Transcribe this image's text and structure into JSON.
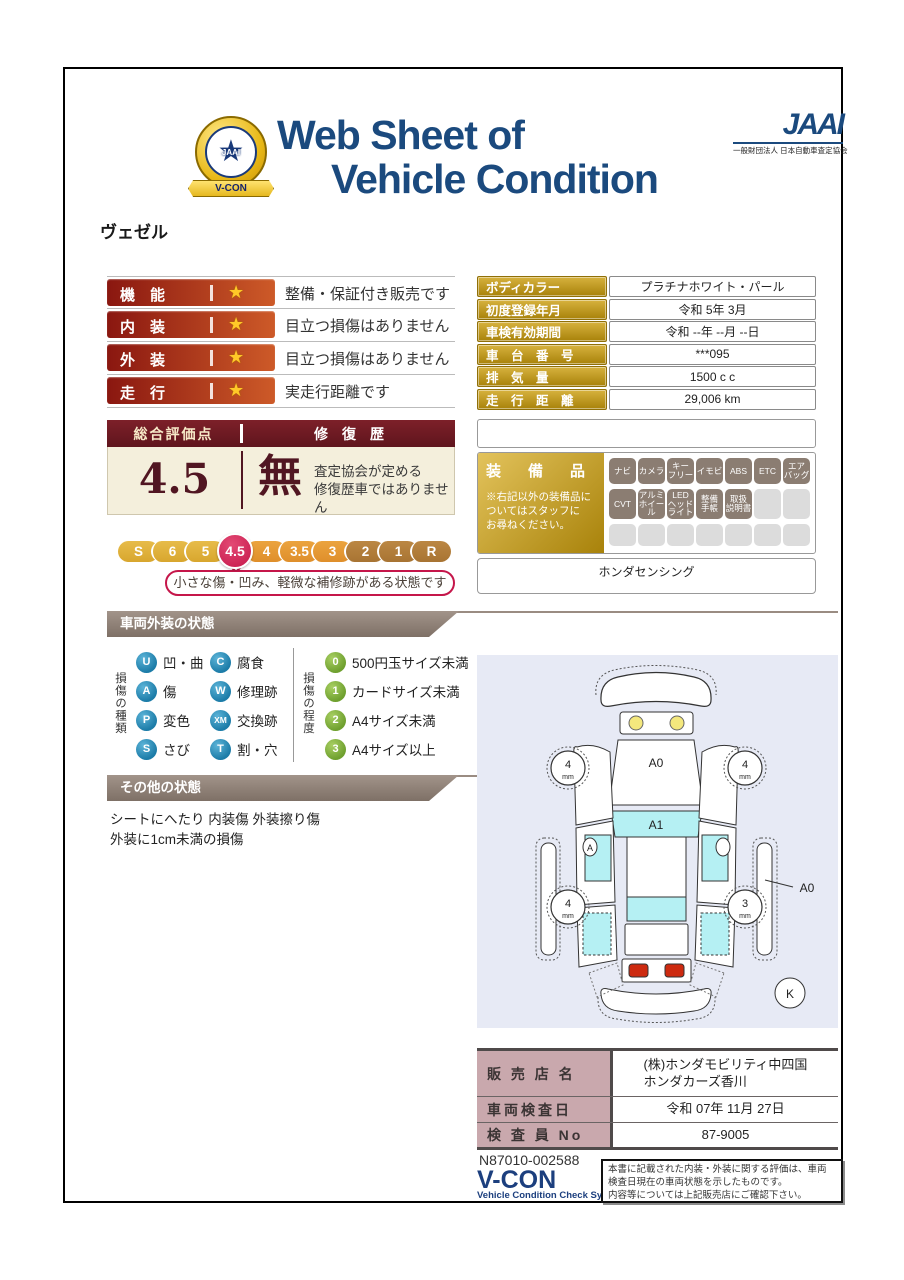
{
  "colors": {
    "title_navy": "#1b4a7e",
    "bar_red_dark": "#8a1710",
    "bar_red_light": "#cd5a28",
    "maroon_dark": "#5f151d",
    "maroon_light": "#7d2029",
    "cream": "#f4efdc",
    "gold_dark": "#a8820a",
    "gold_light": "#d7b23e",
    "scale_gold": "#d8a62e",
    "scale_orange": "#df8f2b",
    "scale_brown": "#a87433",
    "selected_crimson": "#c5164a",
    "type_badge_blue": "#1c7ca8",
    "degree_badge_green": "#6fa02f",
    "equip_badge": "#8b7d72",
    "banner_taupe": "#8a7c73",
    "dealer_label_pink": "#c9a8ad",
    "vcon_blue": "#1c3f7e",
    "diagram_bg": "#e7eaf5",
    "glass_cyan": "#b5f0f3"
  },
  "header": {
    "emblem_ribbon": "V-CON",
    "emblem_jaai": "JAAI",
    "emblem_star": "★",
    "title_line1": "Web Sheet of",
    "title_line2": "Vehicle Condition",
    "jaai_logo": "JAAI",
    "jaai_subtitle": "一般財団法人 日本自動車査定協会"
  },
  "vehicle_name": "ヴェゼル",
  "ratings": {
    "star_glyph": "★",
    "rows": [
      {
        "label": "機　能",
        "description": "整備・保証付き販売です"
      },
      {
        "label": "内　装",
        "description": "目立つ損傷はありません"
      },
      {
        "label": "外　装",
        "description": "目立つ損傷はありません"
      },
      {
        "label": "走　行",
        "description": "実走行距離です"
      }
    ]
  },
  "overall": {
    "score_header": "総合評価点",
    "repair_header": "修　復　歴",
    "score": "4.5",
    "repair_value": "無",
    "repair_note": "査定協会が定める\n修復歴車ではありません",
    "scale": [
      {
        "label": "S"
      },
      {
        "label": "6"
      },
      {
        "label": "5"
      },
      {
        "label": "4.5"
      },
      {
        "label": "4"
      },
      {
        "label": "3.5"
      },
      {
        "label": "3"
      },
      {
        "label": "2"
      },
      {
        "label": "1"
      },
      {
        "label": "R"
      }
    ],
    "selected": "4.5",
    "bubble": "小さな傷・凹み、軽微な補修跡がある状態です"
  },
  "vehicle_info": {
    "rows": [
      {
        "label": "ボディカラー",
        "value": "プラチナホワイト・パール"
      },
      {
        "label": "初度登録年月",
        "value": "令和 5年 3月"
      },
      {
        "label": "車検有効期間",
        "value": "令和 --年 --月 --日"
      },
      {
        "label": "車　台　番　号",
        "value": "***095"
      },
      {
        "label": "排　気　量",
        "value": "1500 c c"
      },
      {
        "label": "走　行　距　離",
        "value": "29,006 km"
      }
    ]
  },
  "equipment": {
    "title": "装　備　品",
    "note": "※右記以外の装備品に\nついてはスタッフに\nお尋ねください。",
    "badges": [
      "ナビ",
      "カメラ",
      "キー\nフリー",
      "イモビ",
      "ABS",
      "ETC",
      "エア\nバッグ",
      "CVT",
      "アルミ\nホイール",
      "LED\nヘッド\nライト",
      "整備\n手帳",
      "取扱\n説明書"
    ],
    "extra": "ホンダセンシング"
  },
  "exterior_legend": {
    "section_title": "車両外装の状態",
    "type_label": "損傷の種類",
    "types_left": [
      {
        "code": "U",
        "label": "凹・曲"
      },
      {
        "code": "A",
        "label": "傷"
      },
      {
        "code": "P",
        "label": "変色"
      },
      {
        "code": "S",
        "label": "さび"
      }
    ],
    "types_right": [
      {
        "code": "C",
        "label": "腐食"
      },
      {
        "code": "W",
        "label": "修理跡"
      },
      {
        "code": "XM",
        "label": "交換跡"
      },
      {
        "code": "T",
        "label": "割・穴"
      }
    ],
    "degree_label": "損傷の程度",
    "degrees": [
      {
        "code": "0",
        "label": "500円玉サイズ未満"
      },
      {
        "code": "1",
        "label": "カードサイズ未満"
      },
      {
        "code": "2",
        "label": "A4サイズ未満"
      },
      {
        "code": "3",
        "label": "A4サイズ以上"
      }
    ]
  },
  "other_condition": {
    "section_title": "その他の状態",
    "text": "シートにへたり 内装傷 外装擦り傷\n外装に1cm未満の損傷"
  },
  "diagram": {
    "hood_label": "A0",
    "windshield_label": "A1",
    "door_marker": "A",
    "rear_fender_label": "A0",
    "corner_label": "K",
    "tire_front_left": "4",
    "tire_front_right": "4",
    "tire_rear_left": "4",
    "tire_rear_right": "3",
    "tire_unit": "mm"
  },
  "dealer": {
    "rows": [
      {
        "label": "販 売 店 名",
        "value": "(株)ホンダモビリティ中四国\nホンダカーズ香川"
      },
      {
        "label": "車両検査日",
        "value": "令和 07年 11月 27日"
      },
      {
        "label": "検 査 員 No",
        "value": "87-9005"
      }
    ]
  },
  "footer": {
    "serial": "N87010-002588",
    "vcon_logo": "V-CON",
    "vcon_subtitle": "Vehicle Condition Check System",
    "disclaimer": "本書に記載された内装・外装に関する評価は、車両\n検査日現在の車両状態を示したものです。\n内容等については上記販売店にご確認下さい。"
  }
}
